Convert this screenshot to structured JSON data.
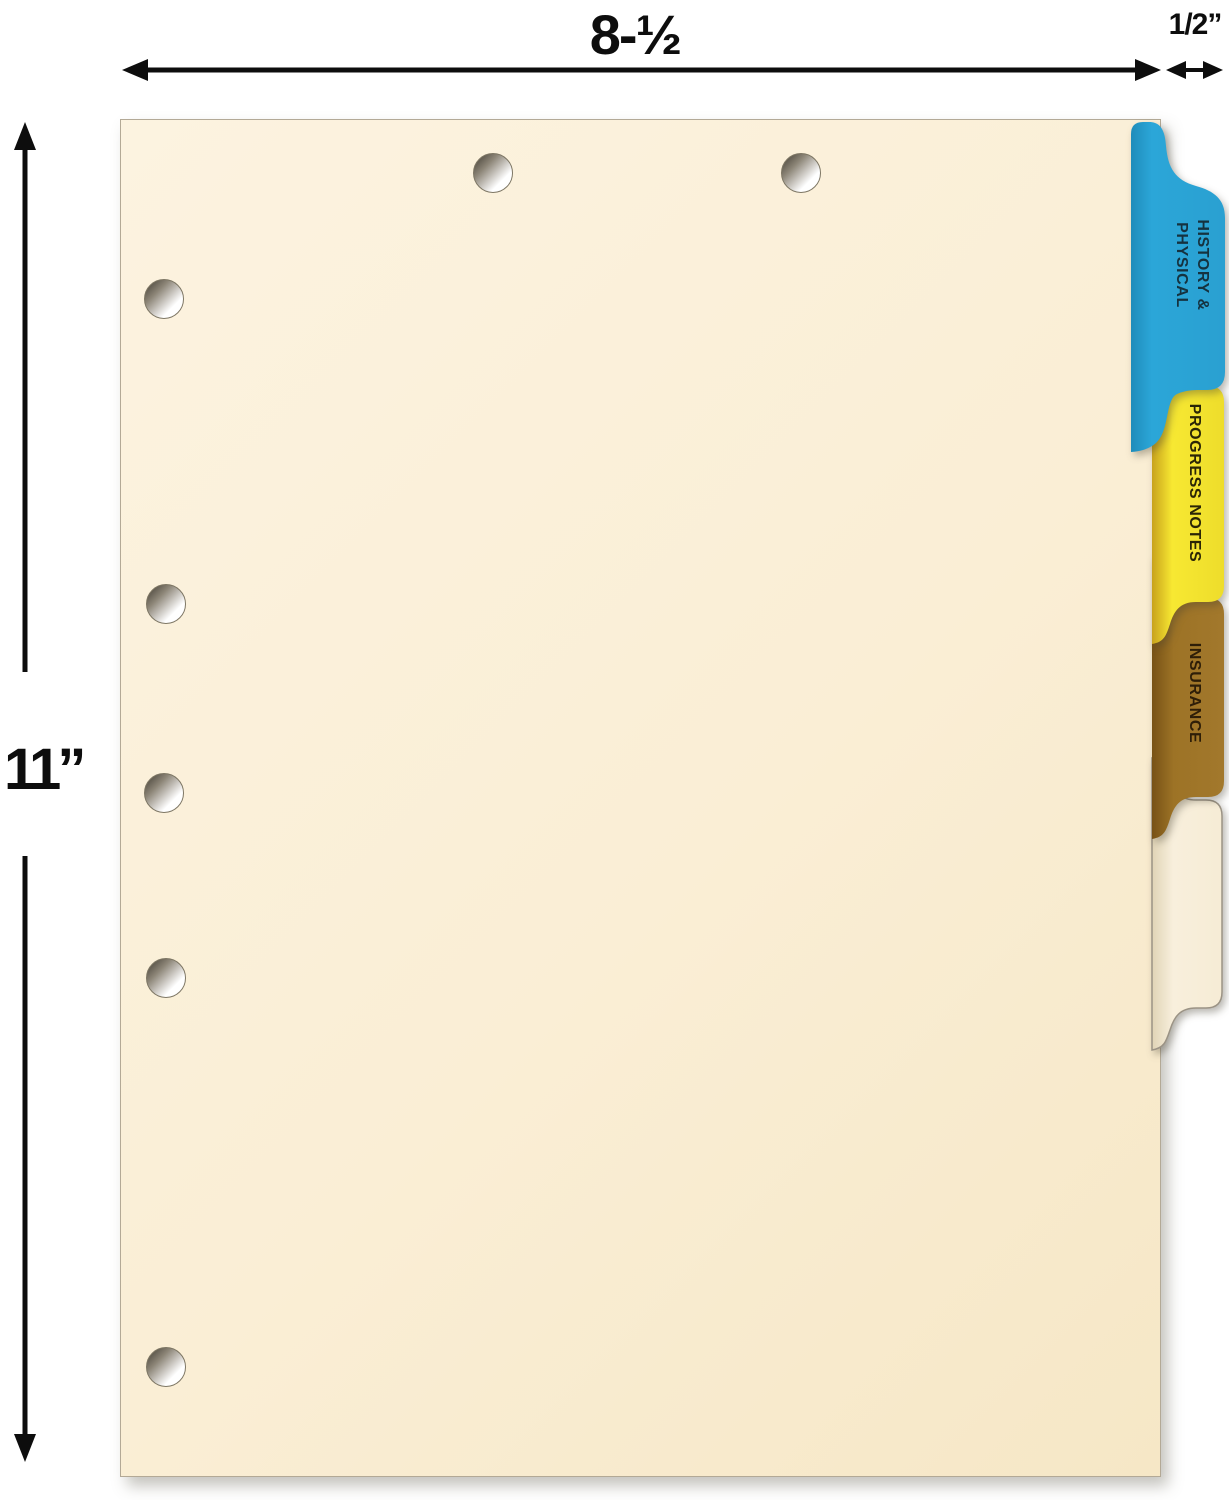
{
  "title": "Medical chart divider sheet with colored side tabs",
  "dimensions": {
    "sheet_width_label": "8-½",
    "tab_width_label": "1/2”",
    "sheet_height_label": "11”"
  },
  "sheet": {
    "color": "#FAEED5",
    "top_hole_count": 2,
    "side_hole_count": 5
  },
  "tabs": [
    {
      "id": "history-physical",
      "label_line1": "HISTORY &",
      "label_line2": "PHYSICAL",
      "color": "#2BA6D8",
      "text_color": "#15323F"
    },
    {
      "id": "progress-notes",
      "label": "PROGRESS NOTES",
      "color": "#F7E832",
      "text_color": "#2B2606"
    },
    {
      "id": "insurance",
      "label": "INSURANCE",
      "color": "#9D7326",
      "text_color": "#2E1E08"
    },
    {
      "id": "blank",
      "label": "",
      "color": "#F8EFDC"
    }
  ]
}
